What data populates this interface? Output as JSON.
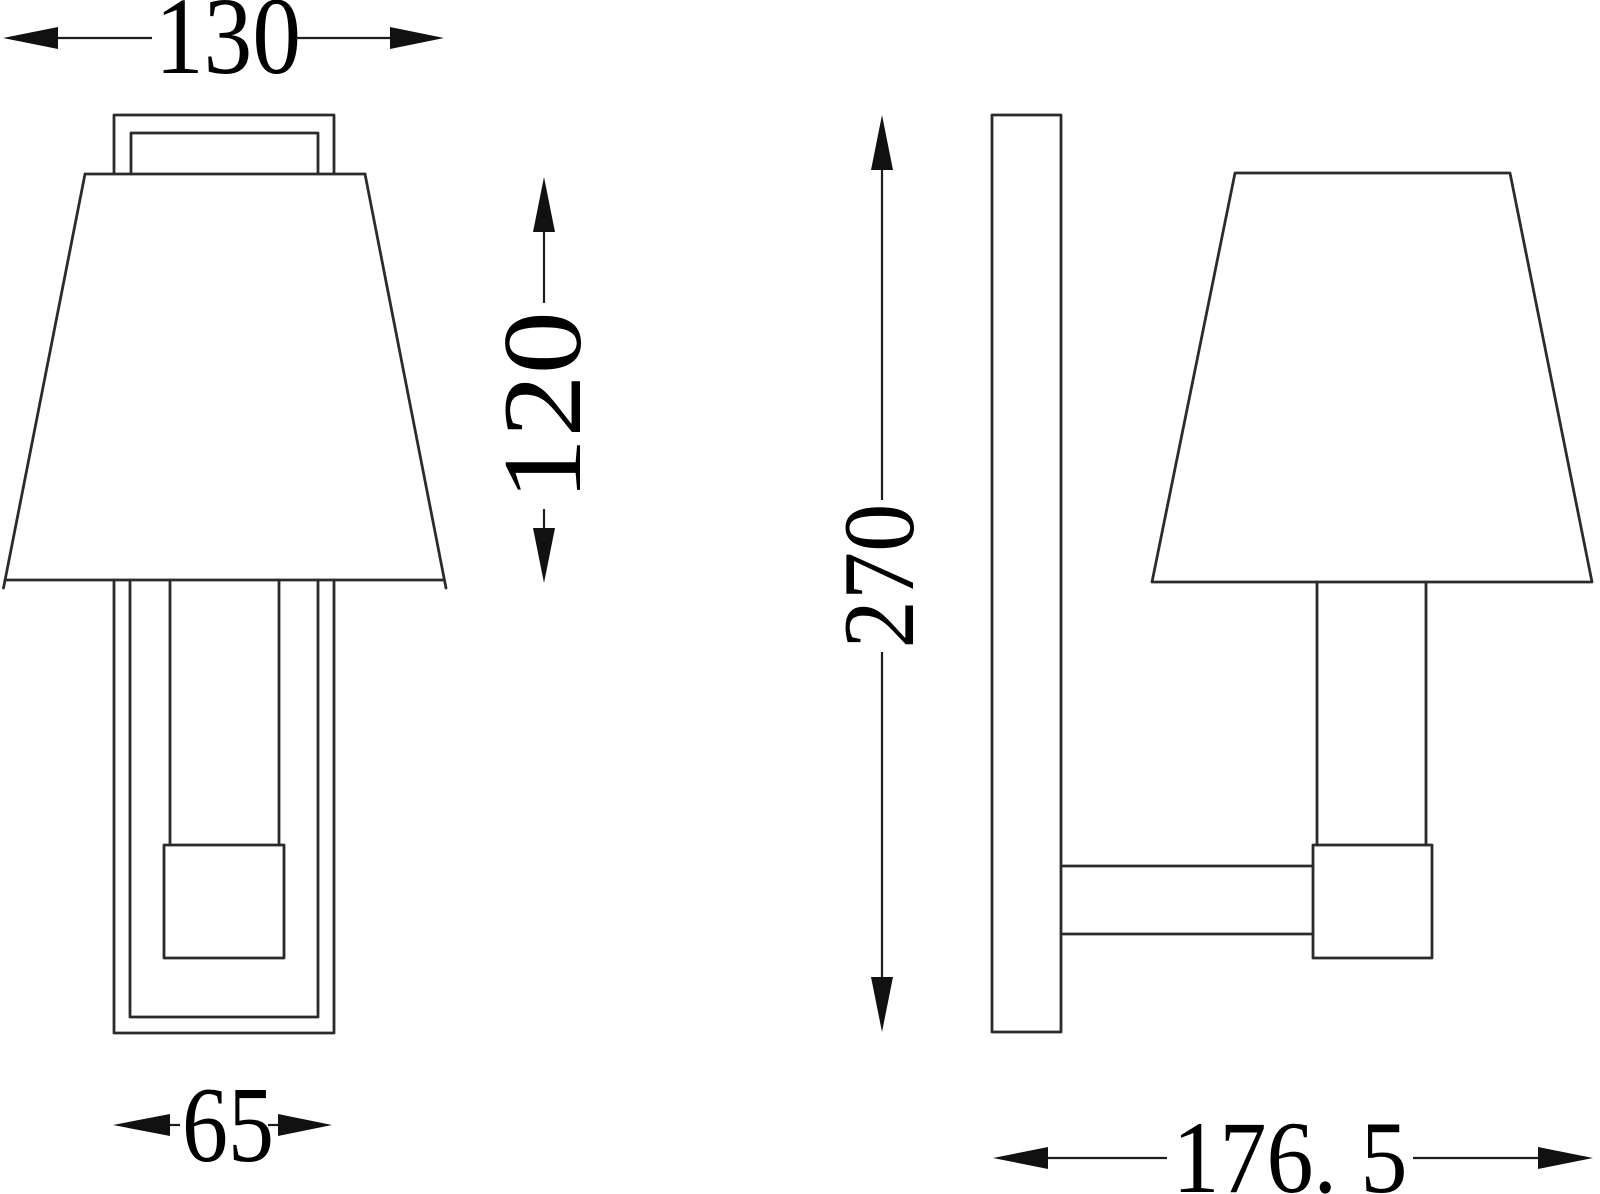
{
  "page": {
    "background_color": "#ffffff",
    "line_color": "#2b2b2b",
    "text_color": "#000000"
  },
  "drawing": {
    "kind": "wall-lamp dimension drawing",
    "views": [
      "front",
      "side"
    ]
  },
  "dimensions": {
    "shade_diameter": "130",
    "shade_height": "120",
    "backplate_width": "65",
    "overall_height": "270",
    "overall_depth": "176. 5"
  }
}
